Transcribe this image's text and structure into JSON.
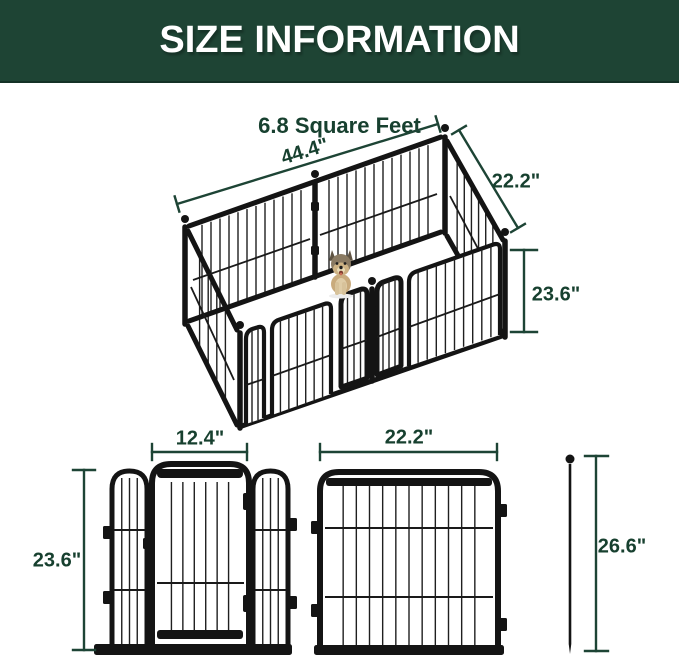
{
  "header": {
    "title": "SIZE INFORMATION"
  },
  "subtitle": "6.8 Square Feet",
  "main_diagram": {
    "name": "6-panel metal pet playpen, isometric view with dog inside",
    "length_label": "44.4\"",
    "width_label": "22.2\"",
    "height_label": "23.6\""
  },
  "door_panel_diagram": {
    "name": "front view of door panel",
    "door_width_label": "12.4\"",
    "height_label": "23.6\""
  },
  "wide_panel_diagram": {
    "name": "front view of single wide panel",
    "width_label": "22.2\""
  },
  "stake_diagram": {
    "name": "ground stake",
    "height_label": "26.6\""
  },
  "colors": {
    "header_bg": "#1e4434",
    "dimension_green": "#1d4435",
    "frame_black": "#141414",
    "dog_tan": "#c9ab7d"
  }
}
